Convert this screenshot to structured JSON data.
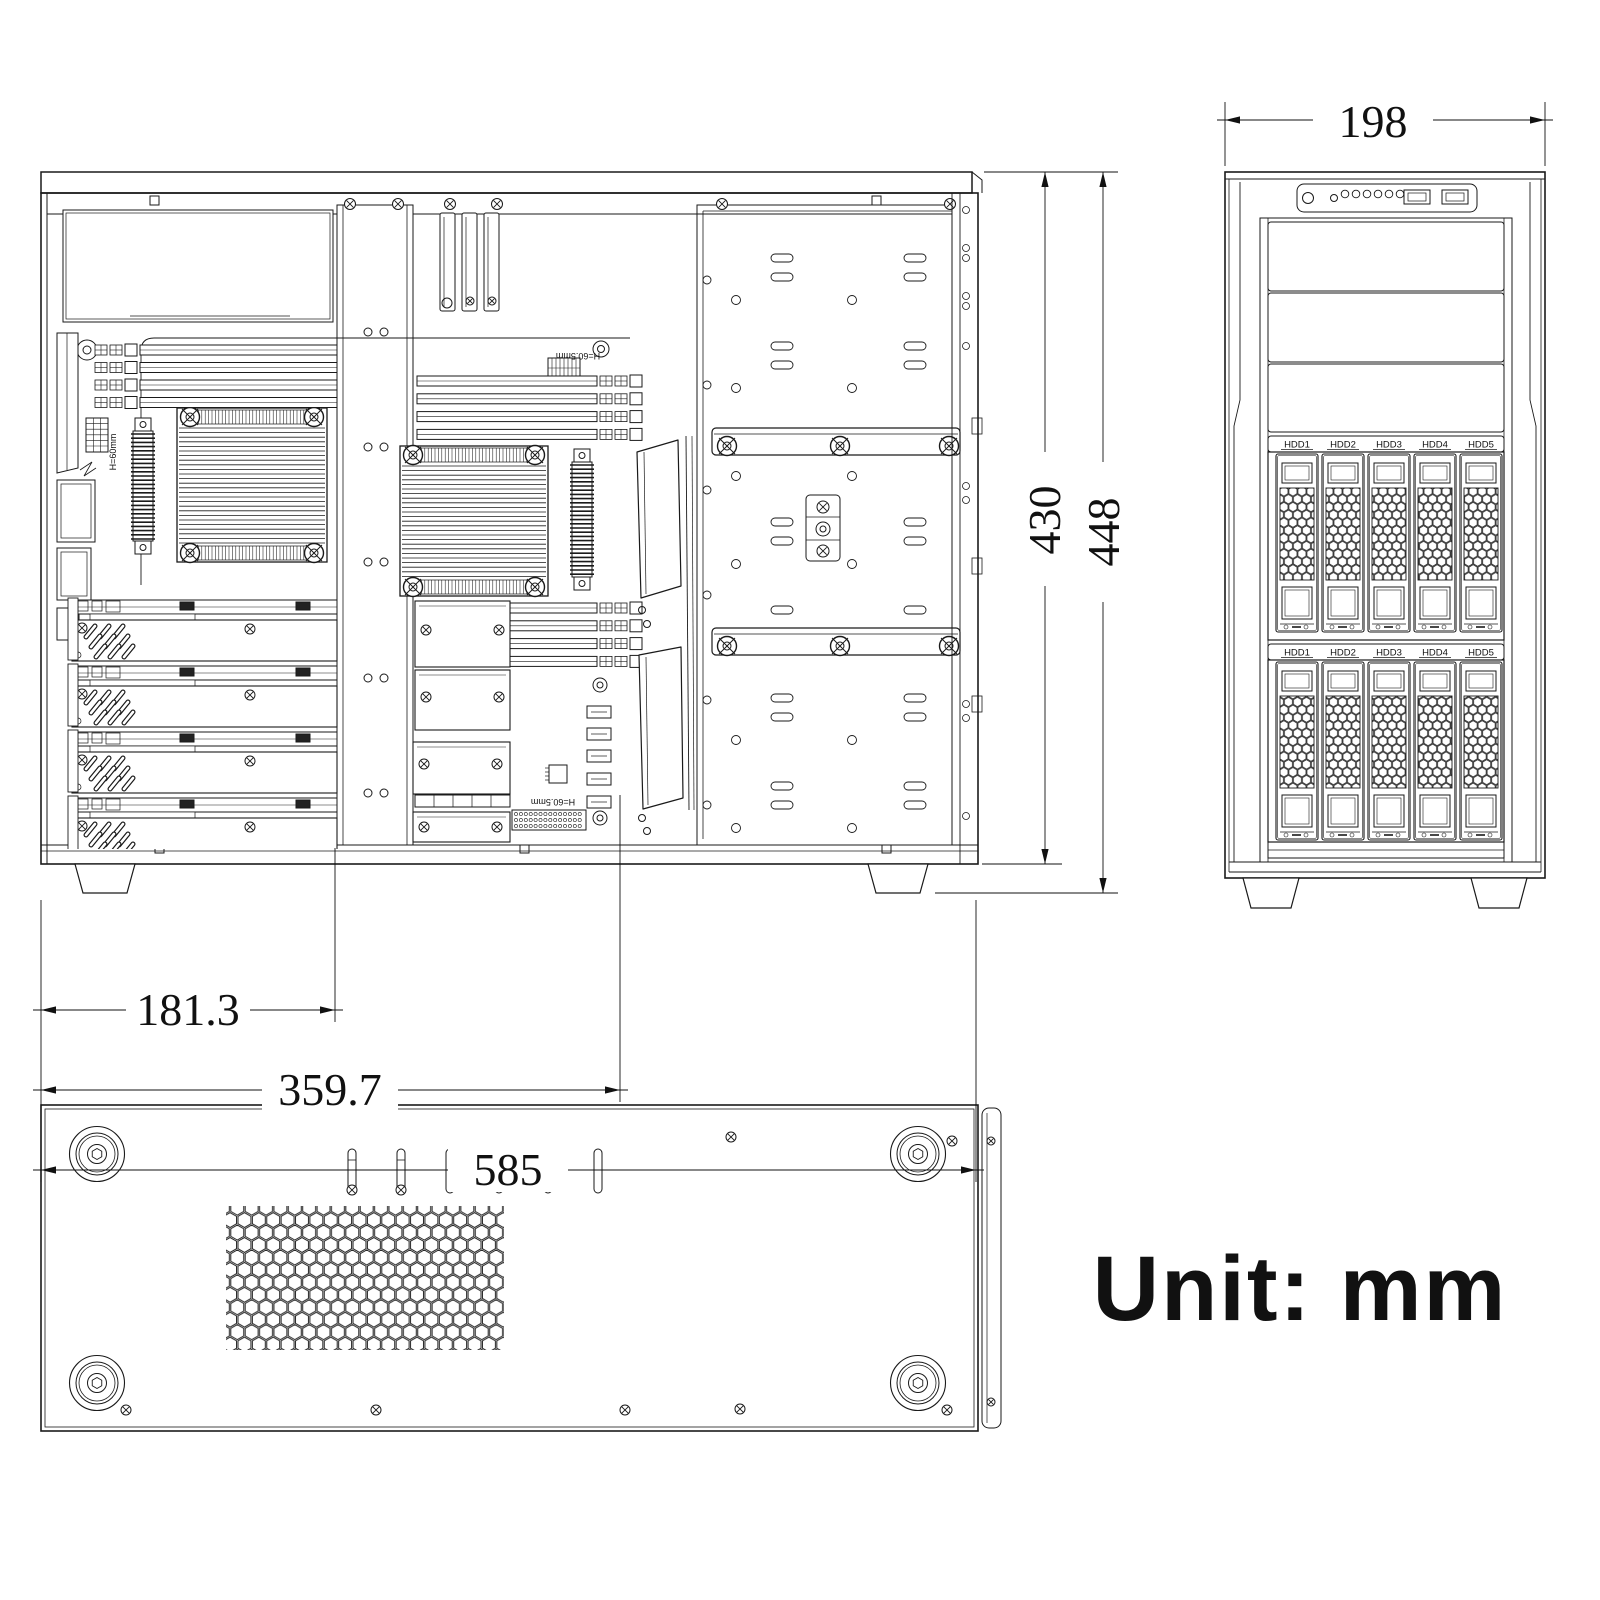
{
  "note": {
    "unit": "Unit: mm"
  },
  "dimensions": {
    "side_width_total": "585",
    "side_width_column": "181.3",
    "side_width_mobo": "359.7",
    "side_height_inner": "430",
    "side_height_total": "448",
    "front_width": "198"
  },
  "front_view": {
    "hdd_labels": [
      "HDD1",
      "HDD2",
      "HDD3",
      "HDD4",
      "HDD5"
    ],
    "cage_count": 2,
    "bay_cover_count": 3
  },
  "side_view": {
    "silkscreen": {
      "cooler_height": "H=60mm",
      "io_height": "H=60.5mm",
      "header_height": "H=60.5mm"
    }
  }
}
